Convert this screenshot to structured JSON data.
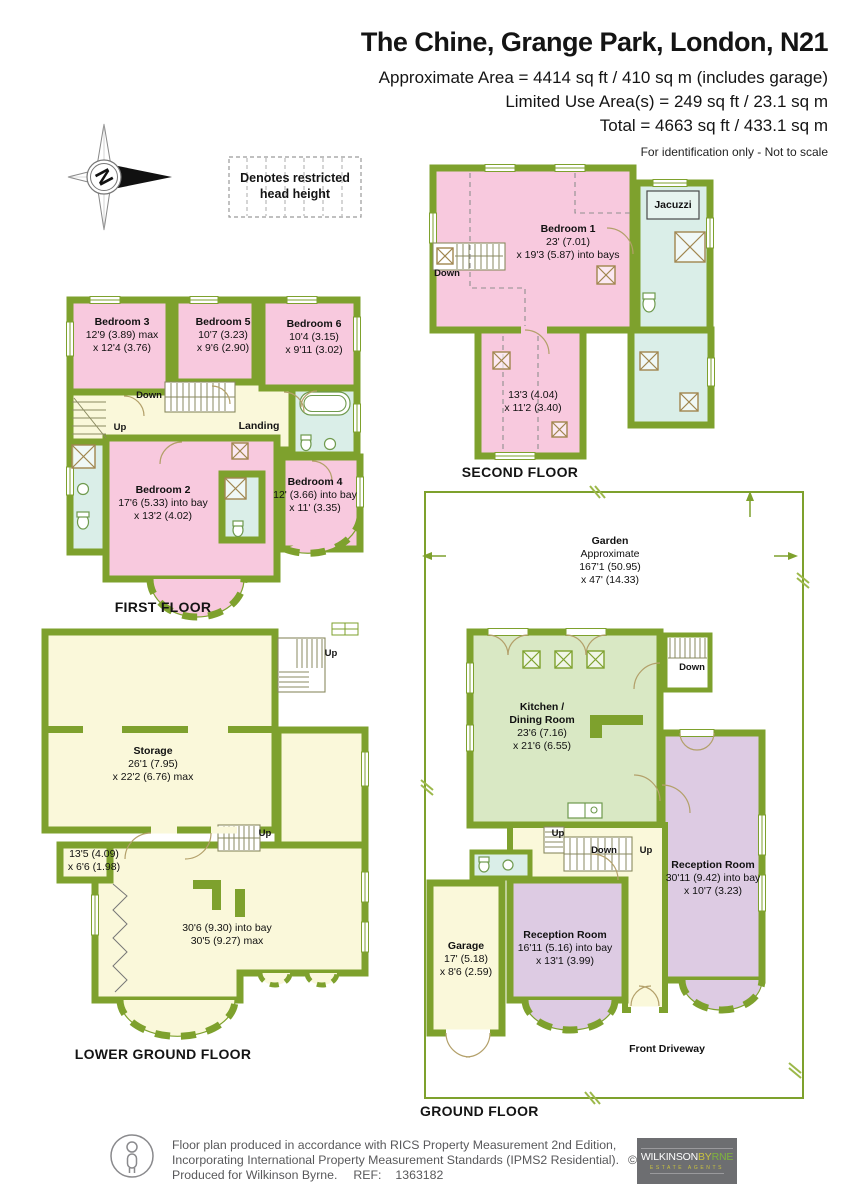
{
  "header": {
    "title": "The Chine, Grange Park, London, N21",
    "approx_area": "Approximate Area = 4414 sq ft / 410 sq m (includes garage)",
    "limited_area": "Limited Use Area(s) = 249 sq ft / 23.1 sq m",
    "total_area": "Total = 4663 sq ft / 433.1 sq m",
    "note": "For identification only - Not to scale"
  },
  "legend": {
    "compass_letter": "N",
    "restricted_line1": "Denotes restricted",
    "restricted_line2": "head height"
  },
  "dir": {
    "up": "Up",
    "down": "Down"
  },
  "second_floor": {
    "label": "SECOND FLOOR",
    "bedroom1": {
      "name": "Bedroom 1",
      "d1": "23' (7.01)",
      "d2": "x 19'3 (5.87) into bays"
    },
    "jacuzzi": "Jacuzzi",
    "stub": {
      "d1": "13'3 (4.04)",
      "d2": "x 11'2 (3.40)"
    }
  },
  "first_floor": {
    "label": "FIRST FLOOR",
    "bedroom3": {
      "name": "Bedroom 3",
      "d1": "12'9 (3.89) max",
      "d2": "x 12'4 (3.76)"
    },
    "bedroom5": {
      "name": "Bedroom 5",
      "d1": "10'7 (3.23)",
      "d2": "x 9'6 (2.90)"
    },
    "bedroom6": {
      "name": "Bedroom 6",
      "d1": "10'4 (3.15)",
      "d2": "x 9'11 (3.02)"
    },
    "bedroom2": {
      "name": "Bedroom 2",
      "d1": "17'6 (5.33) into bay",
      "d2": "x 13'2 (4.02)"
    },
    "bedroom4": {
      "name": "Bedroom 4",
      "d1": "12' (3.66) into bay",
      "d2": "x 11' (3.35)"
    },
    "landing": "Landing"
  },
  "lower_ground": {
    "label": "LOWER GROUND FLOOR",
    "storage": {
      "name": "Storage",
      "d1": "26'1 (7.95)",
      "d2": "x 22'2 (6.76) max"
    },
    "corridor": {
      "d1": "13'5 (4.09)",
      "d2": "x 6'6 (1.98)"
    },
    "big_room": {
      "d1": "30'6 (9.30) into bay",
      "d2": "30'5 (9.27) max"
    }
  },
  "ground_floor": {
    "label": "GROUND FLOOR",
    "garden": {
      "name": "Garden",
      "l1": "Approximate",
      "l2": "167'1 (50.95)",
      "l3": "x 47' (14.33)"
    },
    "kitchen": {
      "l1": "Kitchen /",
      "l2": "Dining Room",
      "d1": "23'6 (7.16)",
      "d2": "x 21'6 (6.55)"
    },
    "reception1": {
      "name": "Reception Room",
      "d1": "30'11 (9.42) into bay",
      "d2": "x 10'7 (3.23)"
    },
    "reception2": {
      "name": "Reception Room",
      "d1": "16'11 (5.16) into bay",
      "d2": "x 13'1 (3.99)"
    },
    "garage": {
      "name": "Garage",
      "d1": "17' (5.18)",
      "d2": "x 8'6 (2.59)"
    },
    "front_driveway": "Front Driveway"
  },
  "footer": {
    "line1": "Floor plan produced in accordance with RICS Property Measurement 2nd Edition,",
    "line2": "Incorporating International Property Measurement Standards (IPMS2 Residential).",
    "copyright": "© nichecom 2025.",
    "produced": "Produced for Wilkinson Byrne.",
    "ref_label": "REF:",
    "ref_value": "1363182",
    "logo_w": "WILKINSON",
    "logo_by": "BY",
    "logo_rne": "RNE",
    "logo_sub": "ESTATE AGENTS"
  },
  "colors": {
    "wall": "#7ea12d",
    "bedroom_pink": "#f8c9de",
    "bathroom_cyan": "#daeee8",
    "hall_cream": "#faf8da",
    "kitchen_green": "#d9e8c4",
    "reception_lavender": "#ddcbe3"
  }
}
